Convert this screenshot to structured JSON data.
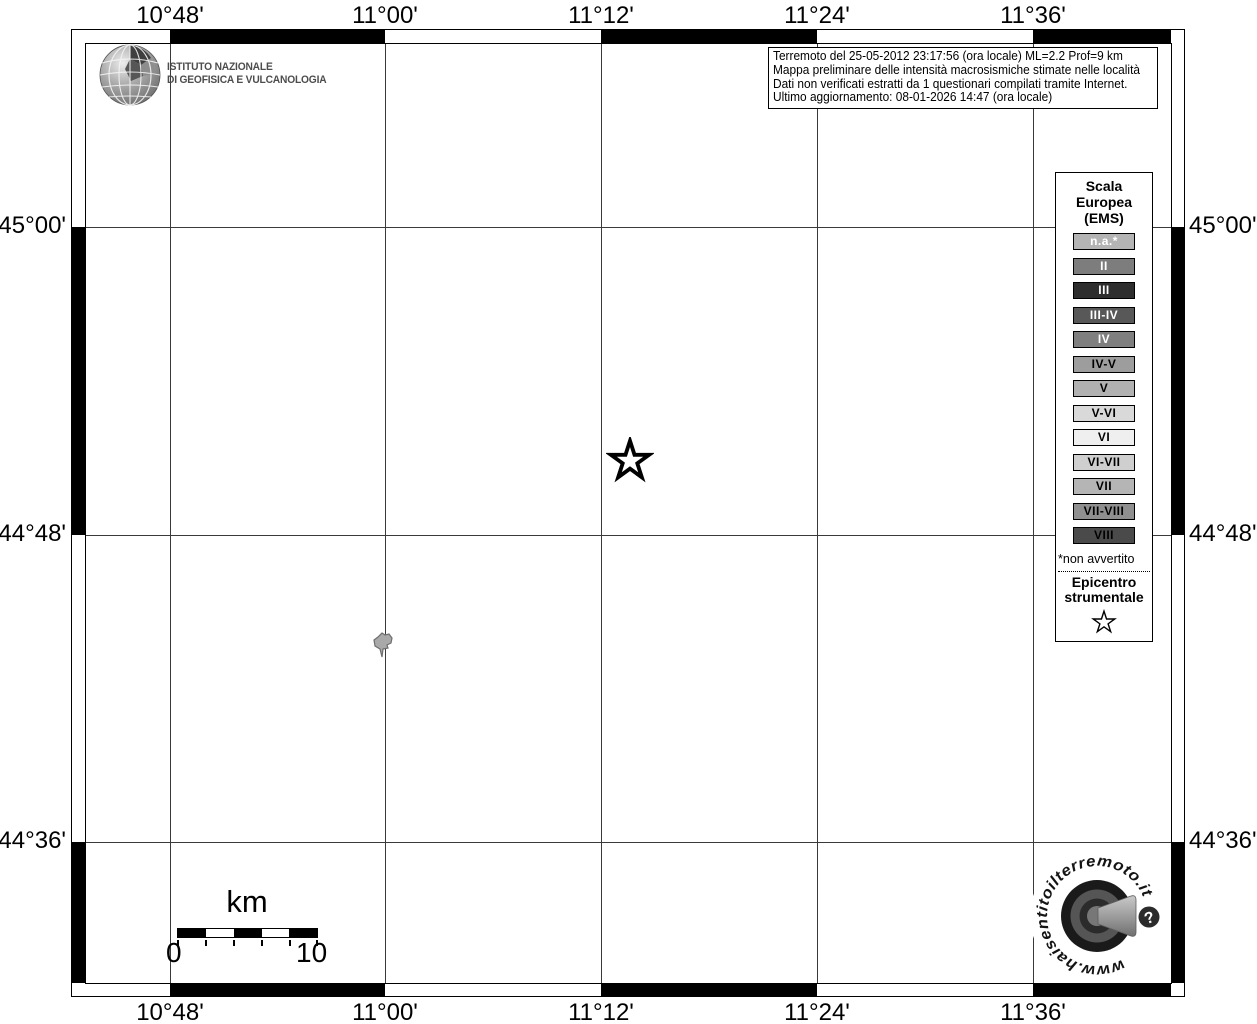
{
  "axis": {
    "top": [
      "10°48'",
      "11°00'",
      "11°12'",
      "11°24'",
      "11°36'"
    ],
    "bottom": [
      "10°48'",
      "11°00'",
      "11°12'",
      "11°24'",
      "11°36'"
    ],
    "left": [
      "45°00'",
      "44°48'",
      "44°36'"
    ],
    "right": [
      "45°00'",
      "44°48'",
      "44°36'"
    ]
  },
  "ingv": {
    "line1": "ISTITUTO NAZIONALE",
    "line2": "DI GEOFISICA E VULCANOLOGIA"
  },
  "info_box": {
    "line1": "Terremoto del 25-05-2012 23:17:56 (ora locale) ML=2.2 Prof=9 km",
    "line2": "Mappa preliminare delle intensità macrosismiche stimate nelle località",
    "line3": "Dati non verificati estratti da 1 questionari compilati tramite Internet.",
    "line4": "Ultimo aggiornamento: 08-01-2026 14:47 (ora locale)"
  },
  "legend": {
    "title": [
      "Scala",
      "Europea",
      "(EMS)"
    ],
    "items": [
      {
        "label": "n.a.*",
        "bg": "#b4b4b4",
        "fg": "#ffffff"
      },
      {
        "label": "II",
        "bg": "#7d7d7d",
        "fg": "#ffffff"
      },
      {
        "label": "III",
        "bg": "#2e2e2e",
        "fg": "#ffffff"
      },
      {
        "label": "III-IV",
        "bg": "#585858",
        "fg": "#ffffff"
      },
      {
        "label": "IV",
        "bg": "#7f7f7f",
        "fg": "#ffffff"
      },
      {
        "label": "IV-V",
        "bg": "#9d9d9d",
        "fg": "#000000"
      },
      {
        "label": "V",
        "bg": "#b1b1b1",
        "fg": "#000000"
      },
      {
        "label": "V-VI",
        "bg": "#d9d9d9",
        "fg": "#000000"
      },
      {
        "label": "VI",
        "bg": "#efefef",
        "fg": "#000000"
      },
      {
        "label": "VI-VII",
        "bg": "#cfcfcf",
        "fg": "#000000"
      },
      {
        "label": "VII",
        "bg": "#b5b5b5",
        "fg": "#000000"
      },
      {
        "label": "VII-VIII",
        "bg": "#8f8f8f",
        "fg": "#000000"
      },
      {
        "label": "VIII",
        "bg": "#4a4a4a",
        "fg": "#000000"
      }
    ],
    "footnote": "*non avvertito",
    "epicenter_label": [
      "Epicentro",
      "strumentale"
    ]
  },
  "scale_bar": {
    "unit": "km",
    "start": "0",
    "end": "10"
  },
  "site_logo": {
    "url_text": "www.haisentitoilterremoto.it",
    "question_mark": "?"
  }
}
